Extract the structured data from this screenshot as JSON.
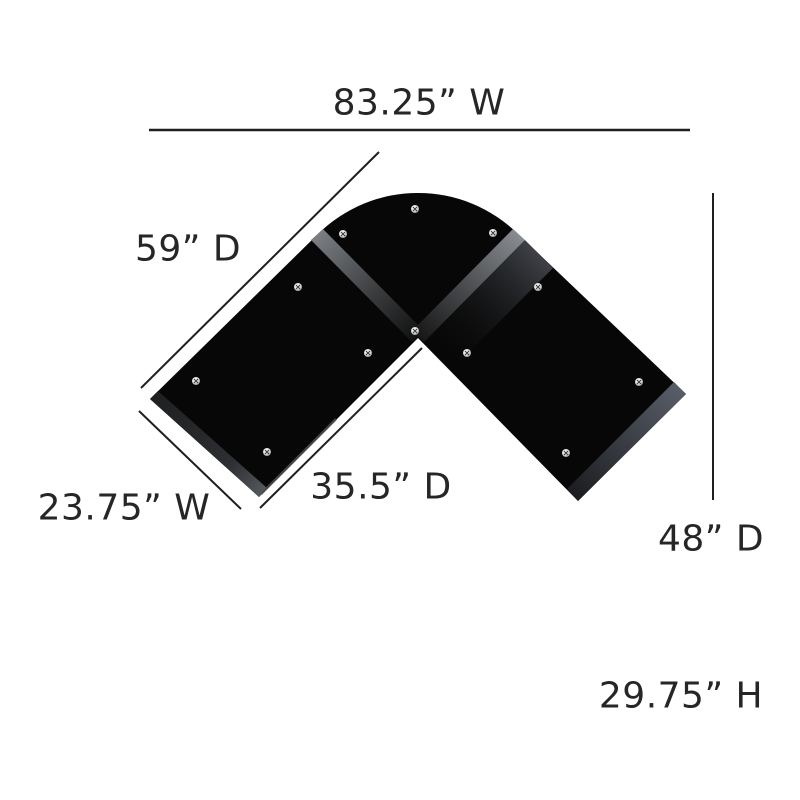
{
  "diagram": {
    "product": "l-shaped-corner-desk-top-view",
    "labels": {
      "top_width": "83.25” W",
      "left_depth": "59” D",
      "bottom_left_width": "23.75” W",
      "inner_depth": "35.5” D",
      "right_depth": "48” D",
      "height": "29.75” H"
    },
    "colors": {
      "background": "#ffffff",
      "desk_top": "#070707",
      "edge_band_right": "#4d525b",
      "edge_band_left": "#26282b",
      "seam_gray": "#6f7377",
      "dimension_line": "#1f1f1f",
      "label_text": "#262626",
      "screw_silver": "#e8e8e8"
    }
  }
}
